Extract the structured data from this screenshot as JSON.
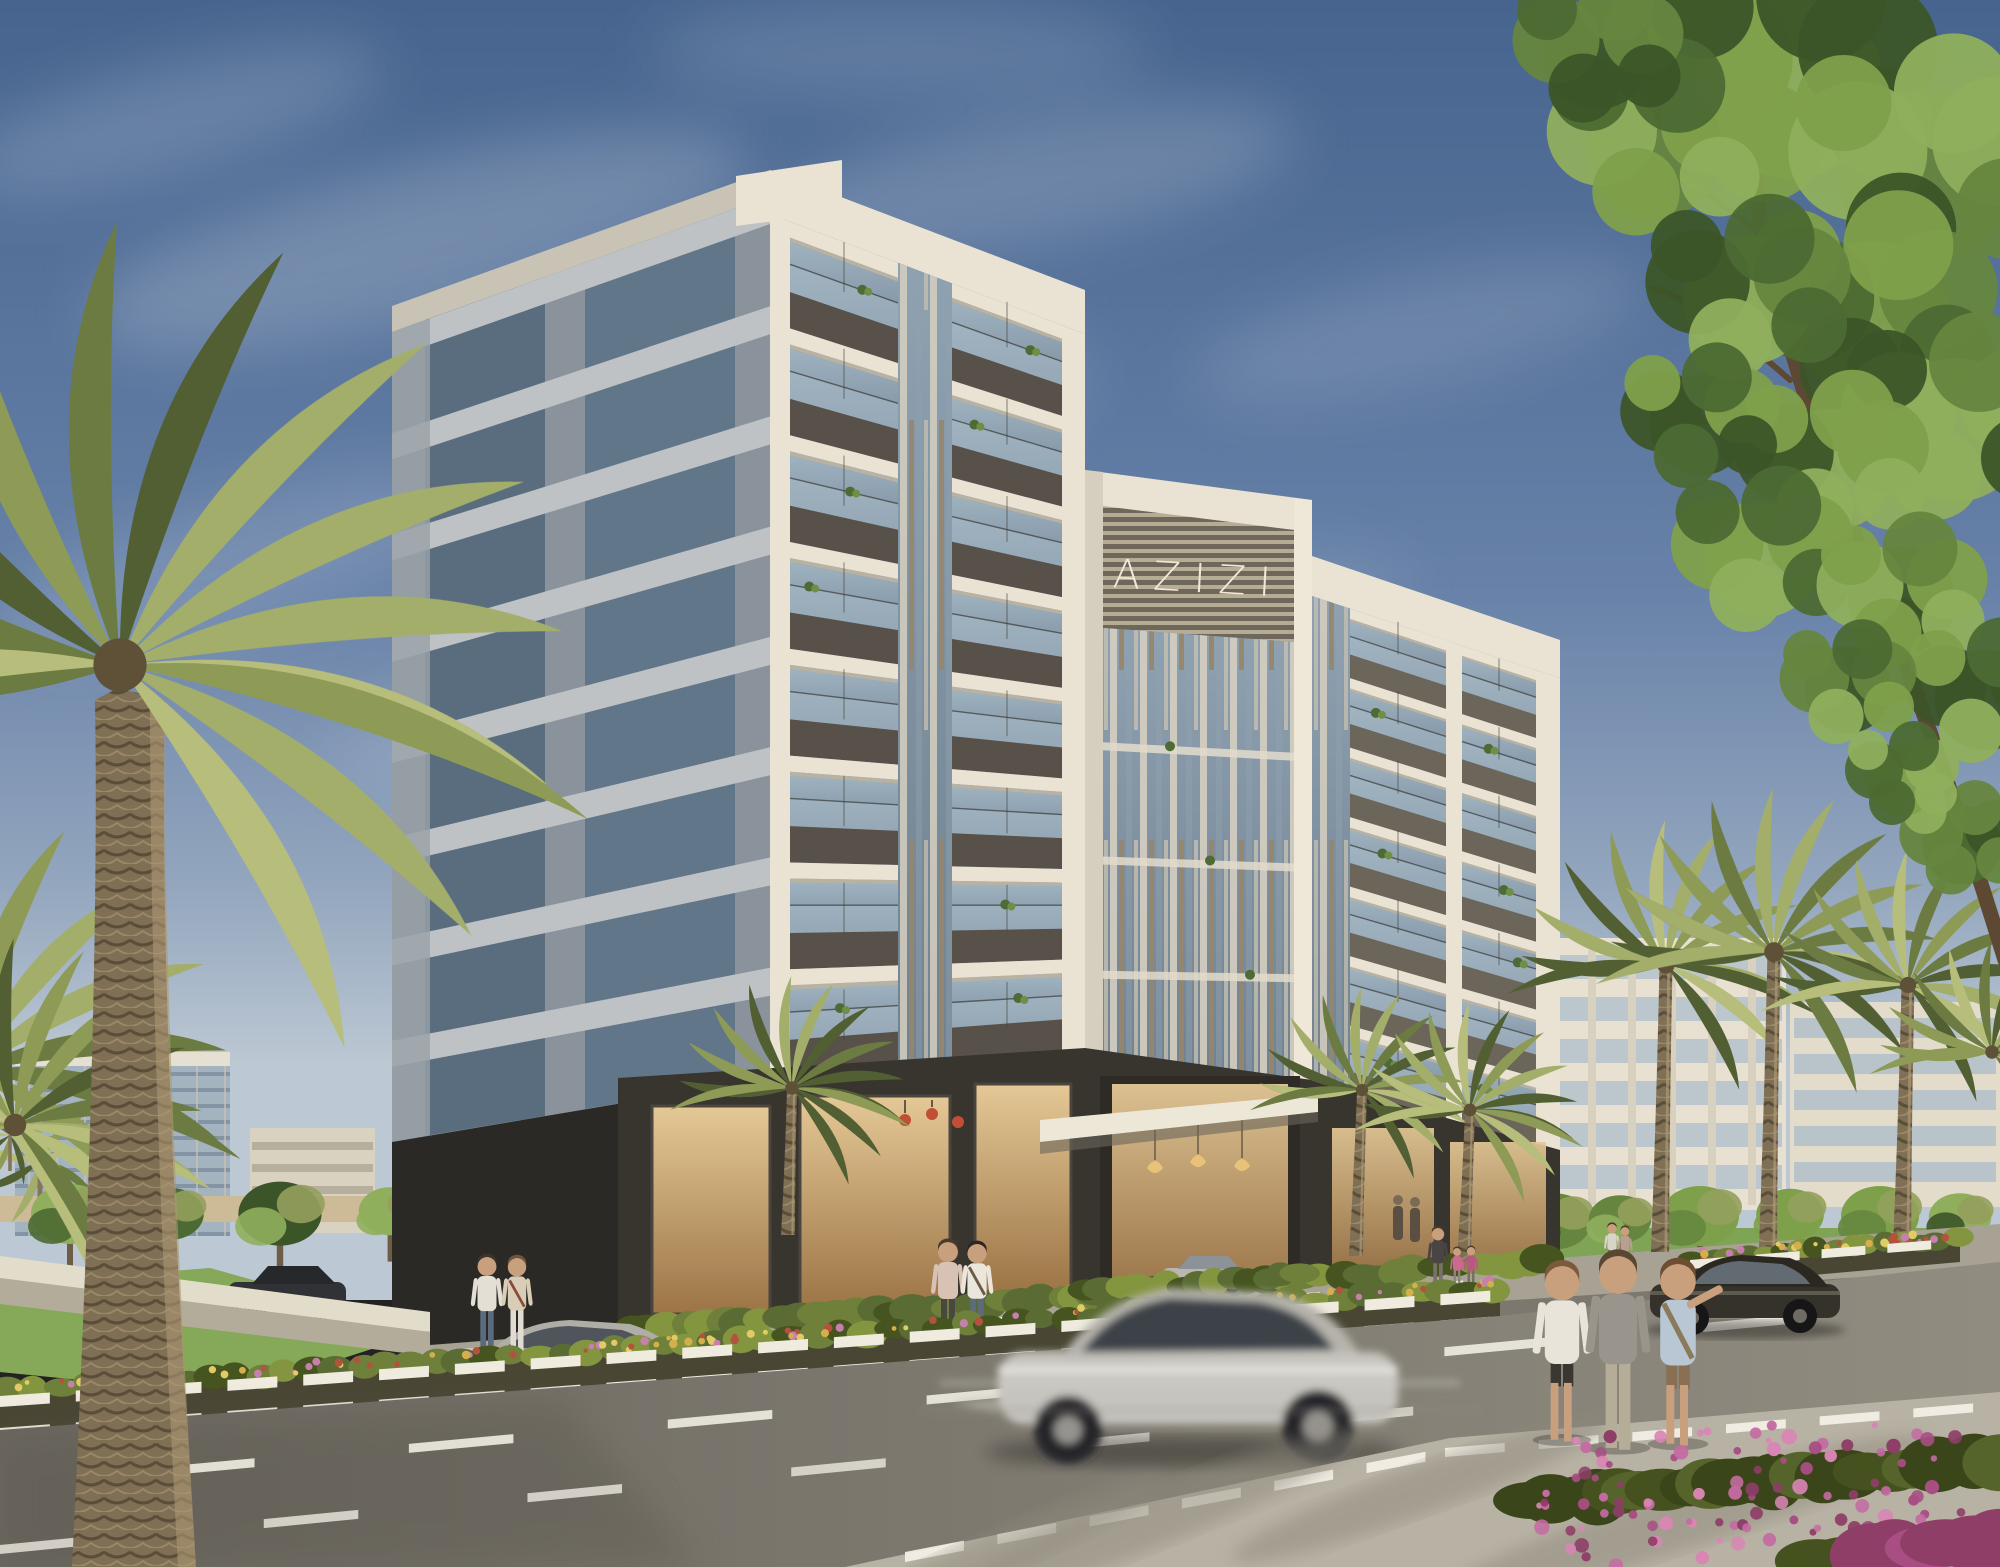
{
  "scene": {
    "type": "architectural-exterior-rendering",
    "setting": "Eight-storey Azizi apartment building on a landscaped boulevard with palms, golden-hour light",
    "sign": {
      "text": "AZIZI"
    },
    "palette": {
      "sky_top": "#46648E",
      "sky_horizon": "#BCC8D3",
      "cloud": "#E7ECF2",
      "facade_white": "#EAE3D3",
      "facade_white_shade": "#C8C3B4",
      "facade_panel": "#57514A",
      "glass_hi": "#9FB2C0",
      "glass_lo": "#7E90A0",
      "rail_glass": "#A9BCC8",
      "louver_light": "#D8D1C1",
      "louver_brown": "#96866C",
      "left_face": "#8A939C",
      "left_band": "#BEC2C4",
      "left_window": "#5A6D7F",
      "podium_stone": "#38342E",
      "podium_dark": "#2B2925",
      "storefront_hi": "#E4C896",
      "storefront_lo": "#9C7446",
      "canopy": "#EDE7D8",
      "road_light": "#918C80",
      "road_dark": "#6B675F",
      "pavement": "#B8B2A4",
      "sidewalk": "#A8A295",
      "curb_white": "#EFEBDF",
      "median_soil": "#4A4634",
      "lawn": "#7CA151",
      "wall_top": "#E2DCCB",
      "wall_face": "#B4AC9B",
      "tan_wall": "#CDBB98",
      "shrub_greens": [
        "#5A6C33",
        "#6E8039",
        "#84953F",
        "#46551F"
      ],
      "flower_colors": [
        "#D3B04B",
        "#C77FAE",
        "#B3533D",
        "#E0CB66"
      ],
      "tree_greens": [
        "#4C6A33",
        "#66863F",
        "#7FA04B",
        "#3C5528",
        "#8FAF5D"
      ],
      "palm_greens": [
        "#8E9B56",
        "#6C7B41",
        "#B7BD7B",
        "#515F33",
        "#A4AE6B"
      ],
      "palm_trunk": "#84755A",
      "branch": "#5D4833",
      "bougainvillea": [
        "#A84E83",
        "#C46CA2",
        "#8E3E67",
        "#D886B4"
      ],
      "car_silver": "#C6C4BE",
      "car_dark": "#35322B"
    },
    "elements": {
      "building": "White grid facade with dark spandrel panels, glass balconies, louvred screens and branded crown",
      "vehicles": [
        "motion-blurred silver coupe",
        "silver coupe on frontage lane",
        "silver sedan by entrance",
        "parked dark sedan",
        "dark sedan driving at right"
      ],
      "people": [
        "couple by storefront",
        "couple at entrance",
        "woman with two children",
        "three pedestrians taking photos",
        "distant couple"
      ],
      "landscape": [
        "large date palm foreground left",
        "street palms at right",
        "leafy tree top right",
        "flowering median strips",
        "bougainvillea bush",
        "lawn and low wall"
      ]
    }
  }
}
